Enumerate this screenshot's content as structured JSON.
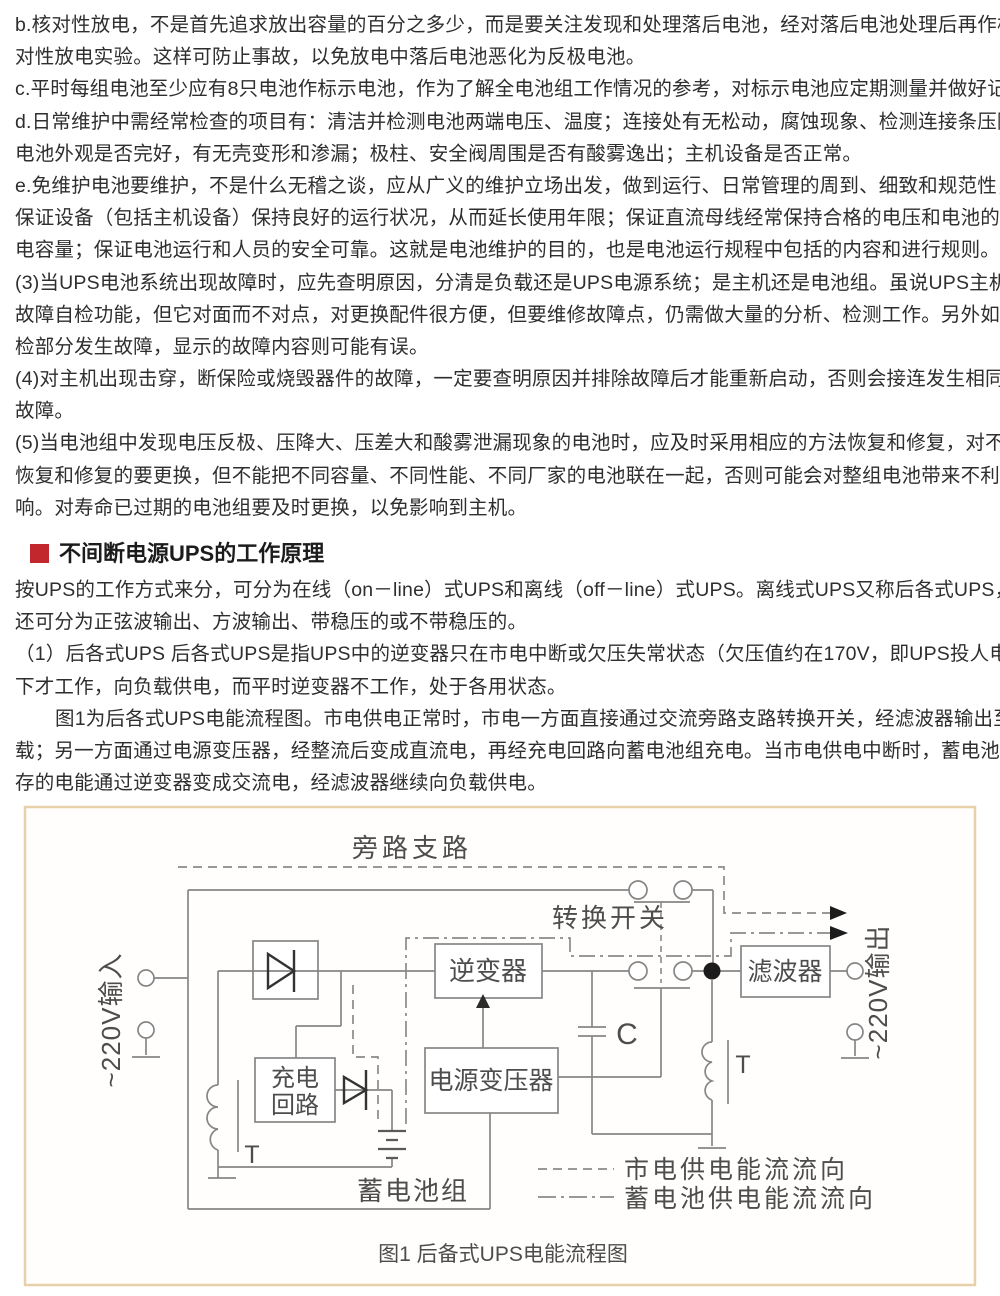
{
  "article": {
    "body1": [
      "b.核对性放电，不是首先追求放出容量的百分之多少，而是要关注发现和处理落后电池，经对落后电池处理后再作核",
      "对性放电实验。这样可防止事故，以免放电中落后电池恶化为反极电池。",
      "c.平时每组电池至少应有8只电池作标示电池，作为了解全电池组工作情况的参考，对标示电池应定期测量并做好记录。",
      "d.日常维护中需经常检查的项目有：清洁并检测电池两端电压、温度；连接处有无松动，腐蚀现象、检测连接条压降；",
      "电池外观是否完好，有无壳变形和渗漏；极柱、安全阀周围是否有酸雾逸出；主机设备是否正常。",
      "e.免维护电池要维护，不是什么无稽之谈，应从广义的维护立场出发，做到运行、日常管理的周到、细致和规范性，",
      "保证设备（包括主机设备）保持良好的运行状况，从而延长使用年限；保证直流母线经常保持合格的电压和电池的放",
      "电容量；保证电池运行和人员的安全可靠。这就是电池维护的目的，也是电池运行规程中包括的内容和进行规则。",
      "(3)当UPS电池系统出现故障时，应先查明原因，分清是负载还是UPS电源系统；是主机还是电池组。虽说UPS主机有",
      "故障自检功能，但它对面而不对点，对更换配件很方便，但要维修故障点，仍需做大量的分析、检测工作。另外如自",
      "检部分发生故障，显示的故障内容则可能有误。",
      "(4)对主机出现击穿，断保险或烧毁器件的故障，一定要查明原因并排除故障后才能重新启动，否则会接连发生相同的",
      "故障。",
      "(5)当电池组中发现电压反极、压降大、压差大和酸雾泄漏现象的电池时，应及时采用相应的方法恢复和修复，对不能",
      "恢复和修复的要更换，但不能把不同容量、不同性能、不同厂家的电池联在一起，否则可能会对整组电池带来不利影",
      "响。对寿命已过期的电池组要及时更换，以免影响到主机。"
    ],
    "header": {
      "text": "不间断电源UPS的工作原理",
      "bullet_color": "#c1272d"
    },
    "body2": [
      "按UPS的工作方式来分，可分为在线（on－line）式UPS和离线（off－line）式UPS。离线式UPS又称后各式UPS，它",
      "还可分为正弦波输出、方波输出、带稳压的或不带稳压的。",
      "（1）后各式UPS 后各式UPS是指UPS中的逆变器只在市电中断或欠压失常状态（欠压值约在170V，即UPS投人电压）",
      "下才工作，向负载供电，而平时逆变器不工作，处于各用状态。",
      "图1为后各式UPS电能流程图。市电供电正常时，市电一方面直接通过交流旁路支路转换开关，经滤波器输出至负",
      "载；另一方面通过电源变压器，经整流后变成直流电，再经充电回路向蓄电池组充电。当市电供电中断时，蓄电池储",
      "存的电能通过逆变器变成交流电，经滤波器继续向负载供电。"
    ]
  },
  "figure": {
    "border_color": "#e8d0aa",
    "caption": "图1 后备式UPS电能流程图",
    "labels": {
      "bypass": "旁路支路",
      "transfer_switch": "转换开关",
      "inverter": "逆变器",
      "transformer": "电源变压器",
      "charge_line1": "充电",
      "charge_line2": "回路",
      "filter": "滤波器",
      "battery_group": "蓄电池组",
      "input": "~220V输入",
      "output": "~220V输出",
      "capacitor": "C",
      "t_left": "T",
      "t_right": "T"
    },
    "legend": {
      "mains": "市电供电能流流向",
      "battery": "蓄电池供电能流流向"
    }
  }
}
